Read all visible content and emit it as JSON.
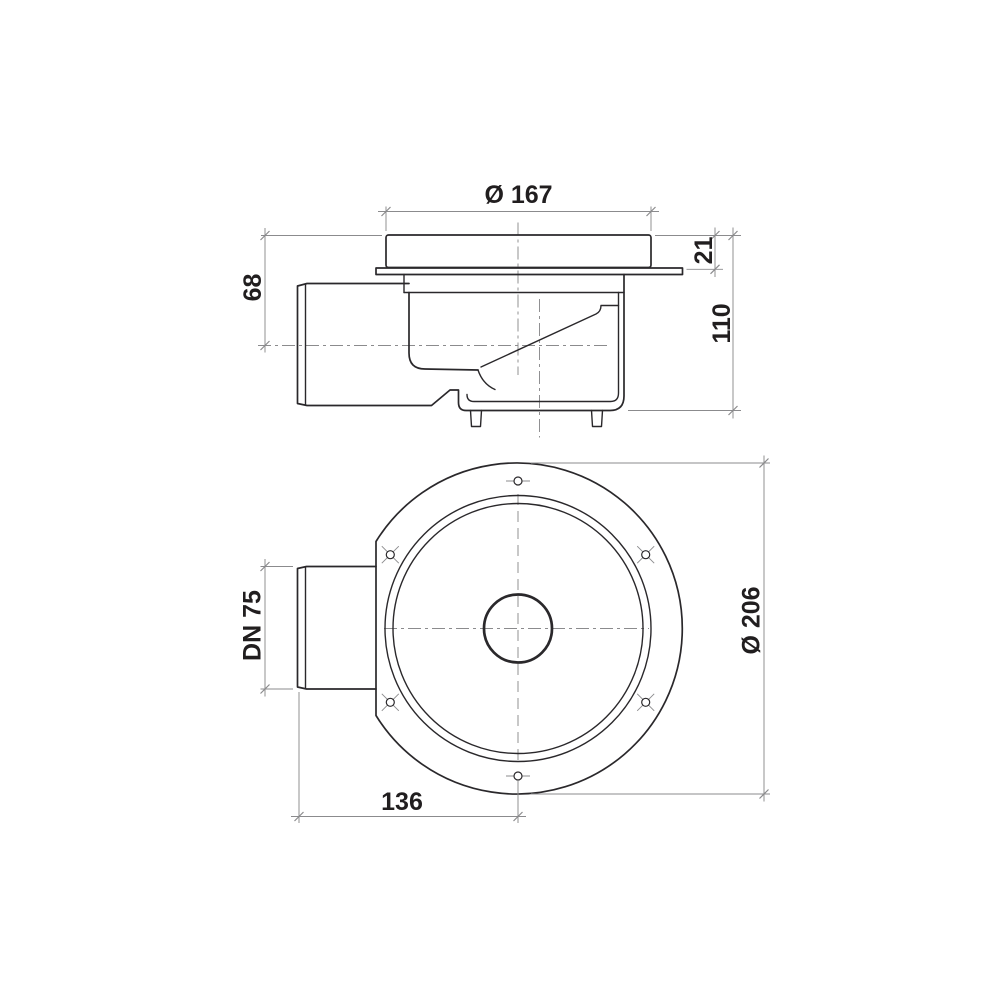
{
  "drawing": {
    "colors": {
      "line": "#2a282b",
      "dim": "#8b8b8d",
      "text": "#211e1f",
      "background": "#ffffff"
    },
    "side_view": {
      "dims": {
        "cover_diameter": "Ø 167",
        "cover_height": "21",
        "total_height": "110",
        "inlet_center_height": "68"
      }
    },
    "top_view": {
      "dims": {
        "inlet_pipe": "DN 75",
        "flange_diameter": "Ø 206",
        "inlet_length": "136"
      }
    }
  }
}
